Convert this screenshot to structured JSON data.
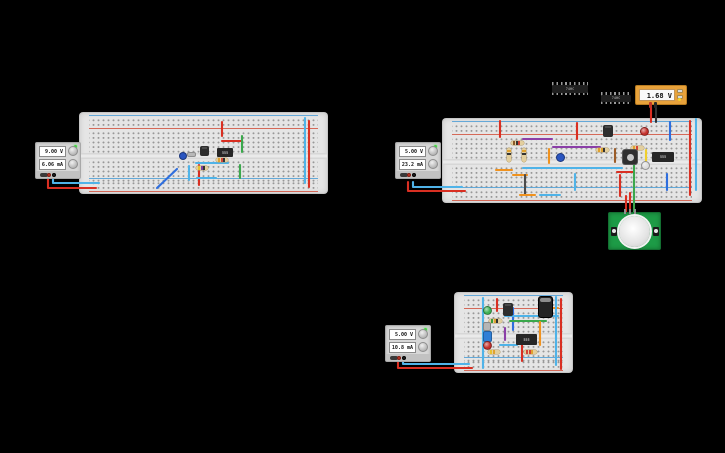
{
  "app": {
    "background": "#000000"
  },
  "supplies": [
    {
      "name": "power-supply-1",
      "voltage": "9.00 V",
      "current": "6.06 mA"
    },
    {
      "name": "power-supply-2",
      "voltage": "5.00 V",
      "current": "23.2 mA"
    },
    {
      "name": "power-supply-3",
      "voltage": "5.00 V",
      "current": "10.8 mA"
    }
  ],
  "multimeter": {
    "reading": "1.68 V",
    "accent": "#e8a23b"
  },
  "ics": [
    {
      "label": "74HC"
    },
    {
      "label": "74HC"
    }
  ],
  "colors": {
    "red": "#d92f22",
    "cyan": "#4fb3e8",
    "blue": "#2e6ede",
    "green": "#3aa84c",
    "orange": "#f0921e",
    "yellow": "#efcf2e",
    "purple": "#8b3fa8",
    "brown": "#9c5c28",
    "dark": "#4a4a4a",
    "black": "#333333",
    "board": "#e5e5e5",
    "led_red": "#c4302b",
    "led_green": "#3cb052",
    "led_white": "#dcdcdc"
  },
  "wires": [
    {
      "c": "red",
      "p": [
        [
          48,
          174
        ],
        [
          48,
          188
        ],
        [
          96,
          188
        ]
      ]
    },
    {
      "c": "cyan",
      "p": [
        [
          53,
          174
        ],
        [
          53,
          183
        ],
        [
          99,
          183
        ]
      ]
    },
    {
      "c": "red",
      "p": [
        [
          222,
          122
        ],
        [
          222,
          136
        ]
      ]
    },
    {
      "c": "red",
      "p": [
        [
          222,
          141
        ],
        [
          242,
          141
        ]
      ]
    },
    {
      "c": "green",
      "p": [
        [
          242,
          136
        ],
        [
          242,
          152
        ]
      ]
    },
    {
      "c": "green",
      "p": [
        [
          240,
          165
        ],
        [
          240,
          178
        ]
      ]
    },
    {
      "c": "cyan",
      "p": [
        [
          196,
          163
        ],
        [
          228,
          163
        ]
      ]
    },
    {
      "c": "red",
      "p": [
        [
          199,
          165
        ],
        [
          199,
          185
        ]
      ]
    },
    {
      "c": "cyan",
      "p": [
        [
          189,
          166
        ],
        [
          189,
          180
        ]
      ]
    },
    {
      "c": "blue",
      "p": [
        [
          157,
          188
        ],
        [
          177,
          169
        ]
      ]
    },
    {
      "c": "cyan",
      "p": [
        [
          197,
          178
        ],
        [
          216,
          178
        ]
      ]
    },
    {
      "c": "cyan",
      "p": [
        [
          305,
          118
        ],
        [
          305,
          183
        ]
      ]
    },
    {
      "c": "red",
      "p": [
        [
          309,
          121
        ],
        [
          309,
          187
        ]
      ]
    },
    {
      "c": "red",
      "p": [
        [
          408,
          182
        ],
        [
          408,
          191
        ],
        [
          465,
          191
        ]
      ]
    },
    {
      "c": "cyan",
      "p": [
        [
          413,
          182
        ],
        [
          413,
          187
        ],
        [
          462,
          187
        ]
      ]
    },
    {
      "c": "red",
      "p": [
        [
          500,
          121
        ],
        [
          500,
          137
        ]
      ]
    },
    {
      "c": "red",
      "p": [
        [
          577,
          123
        ],
        [
          577,
          139
        ]
      ]
    },
    {
      "c": "blue",
      "p": [
        [
          670,
          122
        ],
        [
          670,
          140
        ]
      ]
    },
    {
      "c": "purple",
      "p": [
        [
          523,
          139
        ],
        [
          552,
          139
        ]
      ]
    },
    {
      "c": "purple",
      "p": [
        [
          553,
          147
        ],
        [
          600,
          147
        ]
      ]
    },
    {
      "c": "orange",
      "p": [
        [
          549,
          149
        ],
        [
          549,
          163
        ]
      ]
    },
    {
      "c": "brown",
      "p": [
        [
          615,
          149
        ],
        [
          615,
          162
        ]
      ]
    },
    {
      "c": "yellow",
      "p": [
        [
          646,
          150
        ],
        [
          646,
          162
        ]
      ]
    },
    {
      "c": "cyan",
      "p": [
        [
          523,
          168
        ],
        [
          622,
          168
        ]
      ]
    },
    {
      "c": "orange",
      "p": [
        [
          496,
          170
        ],
        [
          512,
          170
        ]
      ]
    },
    {
      "c": "orange",
      "p": [
        [
          513,
          175
        ],
        [
          527,
          175
        ]
      ]
    },
    {
      "c": "red",
      "p": [
        [
          617,
          172
        ],
        [
          634,
          172
        ]
      ]
    },
    {
      "c": "dark",
      "p": [
        [
          525,
          175
        ],
        [
          525,
          194
        ]
      ]
    },
    {
      "c": "cyan",
      "p": [
        [
          575,
          174
        ],
        [
          575,
          190
        ]
      ]
    },
    {
      "c": "red",
      "p": [
        [
          620,
          175
        ],
        [
          620,
          196
        ]
      ]
    },
    {
      "c": "blue",
      "p": [
        [
          667,
          174
        ],
        [
          667,
          190
        ]
      ]
    },
    {
      "c": "green",
      "p": [
        [
          634,
          160
        ],
        [
          634,
          213
        ]
      ]
    },
    {
      "c": "red",
      "p": [
        [
          626,
          196
        ],
        [
          626,
          213
        ]
      ]
    },
    {
      "c": "red",
      "p": [
        [
          630,
          193
        ],
        [
          630,
          213
        ]
      ]
    },
    {
      "c": "red",
      "p": [
        [
          651,
          106
        ],
        [
          651,
          122
        ]
      ]
    },
    {
      "c": "black",
      "p": [
        [
          656,
          106
        ],
        [
          656,
          122
        ]
      ]
    },
    {
      "c": "red",
      "p": [
        [
          690,
          121
        ],
        [
          690,
          195
        ]
      ]
    },
    {
      "c": "cyan",
      "p": [
        [
          696,
          119
        ],
        [
          696,
          190
        ]
      ]
    },
    {
      "c": "orange",
      "p": [
        [
          520,
          195
        ],
        [
          535,
          195
        ]
      ]
    },
    {
      "c": "cyan",
      "p": [
        [
          540,
          195
        ],
        [
          560,
          195
        ]
      ]
    },
    {
      "c": "red",
      "p": [
        [
          398,
          362
        ],
        [
          398,
          368
        ],
        [
          472,
          368
        ]
      ]
    },
    {
      "c": "cyan",
      "p": [
        [
          403,
          362
        ],
        [
          403,
          364
        ],
        [
          469,
          364
        ]
      ]
    },
    {
      "c": "cyan",
      "p": [
        [
          483,
          298
        ],
        [
          483,
          368
        ]
      ]
    },
    {
      "c": "red",
      "p": [
        [
          497,
          299
        ],
        [
          497,
          311
        ]
      ]
    },
    {
      "c": "blue",
      "p": [
        [
          513,
          308
        ],
        [
          513,
          330
        ]
      ]
    },
    {
      "c": "cyan",
      "p": [
        [
          505,
          316
        ],
        [
          558,
          316
        ]
      ]
    },
    {
      "c": "orange",
      "p": [
        [
          545,
          308
        ],
        [
          558,
          308
        ]
      ]
    },
    {
      "c": "green",
      "p": [
        [
          510,
          321
        ],
        [
          546,
          321
        ]
      ]
    },
    {
      "c": "orange",
      "p": [
        [
          540,
          322
        ],
        [
          540,
          345
        ]
      ]
    },
    {
      "c": "purple",
      "p": [
        [
          505,
          328
        ],
        [
          505,
          340
        ]
      ]
    },
    {
      "c": "red",
      "p": [
        [
          522,
          345
        ],
        [
          522,
          361
        ]
      ]
    },
    {
      "c": "cyan",
      "p": [
        [
          500,
          345
        ],
        [
          517,
          345
        ]
      ]
    },
    {
      "c": "cyan",
      "p": [
        [
          556,
          297
        ],
        [
          556,
          365
        ]
      ]
    },
    {
      "c": "red",
      "p": [
        [
          561,
          299
        ],
        [
          561,
          369
        ]
      ]
    }
  ],
  "parts": [
    {
      "t": "disc",
      "name": "capacitor-disc",
      "x": 179,
      "y": 152,
      "w": 8,
      "h": 8,
      "c": "#2a55c0"
    },
    {
      "t": "crystal",
      "name": "crystal",
      "x": 187,
      "y": 152,
      "w": 9,
      "h": 5
    },
    {
      "t": "transistor",
      "name": "transistor",
      "x": 200,
      "y": 146,
      "w": 9,
      "h": 10
    },
    {
      "t": "chip",
      "name": "timer-ic",
      "x": 217,
      "y": 148,
      "w": 16,
      "h": 9,
      "label": "555"
    },
    {
      "t": "res_h",
      "name": "resistor",
      "x": 216,
      "y": 158,
      "w": 12,
      "h": 4,
      "bands": [
        "#e0a12f",
        "#d44436",
        "#333333"
      ]
    },
    {
      "t": "res_h",
      "name": "resistor",
      "x": 196,
      "y": 166,
      "w": 12,
      "h": 4,
      "bands": [
        "#e8c12f",
        "#7b3fa0",
        "#333333"
      ]
    },
    {
      "t": "res_h",
      "name": "resistor",
      "x": 511,
      "y": 141,
      "w": 13,
      "h": 4,
      "bands": [
        "#8a5a2a",
        "#333333",
        "#d44436"
      ]
    },
    {
      "t": "res_v",
      "name": "resistor",
      "x": 507,
      "y": 148,
      "w": 4,
      "h": 14,
      "bands": [
        "#e0a12f",
        "#333333"
      ]
    },
    {
      "t": "res_v",
      "name": "resistor",
      "x": 522,
      "y": 148,
      "w": 4,
      "h": 14,
      "bands": [
        "#e0a12f",
        "#333333"
      ]
    },
    {
      "t": "disc",
      "name": "capacitor-disc",
      "x": 556,
      "y": 153,
      "w": 9,
      "h": 9,
      "c": "#2a55c0"
    },
    {
      "t": "transistor",
      "name": "transistor",
      "x": 603,
      "y": 125,
      "w": 10,
      "h": 12
    },
    {
      "t": "led",
      "name": "led-red",
      "x": 640,
      "y": 127,
      "w": 9,
      "h": 9,
      "c": "#c4302b"
    },
    {
      "t": "res_h",
      "name": "resistor",
      "x": 596,
      "y": 148,
      "w": 13,
      "h": 4,
      "bands": [
        "#e0a12f",
        "#e0a12f",
        "#333333"
      ]
    },
    {
      "t": "res_h",
      "name": "resistor",
      "x": 631,
      "y": 146,
      "w": 13,
      "h": 4,
      "bands": [
        "#e0a12f",
        "#d44436"
      ]
    },
    {
      "t": "pushbutton",
      "name": "pushbutton",
      "x": 623,
      "y": 150,
      "w": 14,
      "h": 14
    },
    {
      "t": "chip",
      "name": "timer-ic",
      "x": 652,
      "y": 152,
      "w": 22,
      "h": 10,
      "label": "555"
    },
    {
      "t": "led",
      "name": "led-white",
      "x": 641,
      "y": 161,
      "w": 9,
      "h": 9,
      "c": "#dcdcdc"
    },
    {
      "t": "led",
      "name": "led-green",
      "x": 483,
      "y": 306,
      "w": 9,
      "h": 9,
      "c": "#3cb052"
    },
    {
      "t": "transistor",
      "name": "transistor",
      "x": 503,
      "y": 303,
      "w": 10,
      "h": 13
    },
    {
      "t": "ecap",
      "name": "capacitor-electrolytic",
      "x": 538,
      "y": 296,
      "w": 15,
      "h": 22
    },
    {
      "t": "res_h",
      "name": "resistor",
      "x": 489,
      "y": 319,
      "w": 13,
      "h": 4,
      "bands": [
        "#3a9c3a",
        "#e0a12f",
        "#333333"
      ]
    },
    {
      "t": "caprect",
      "name": "capacitor",
      "x": 483,
      "y": 322,
      "w": 8,
      "h": 9,
      "c": "#b5b5b5"
    },
    {
      "t": "caprect",
      "name": "capacitor",
      "x": 483,
      "y": 331,
      "w": 9,
      "h": 11,
      "c": "#2f7fd6"
    },
    {
      "t": "chip",
      "name": "timer-ic",
      "x": 516,
      "y": 334,
      "w": 21,
      "h": 11,
      "label": "555"
    },
    {
      "t": "led",
      "name": "led-red",
      "x": 483,
      "y": 341,
      "w": 9,
      "h": 9,
      "c": "#c4302b"
    },
    {
      "t": "res_h",
      "name": "resistor",
      "x": 488,
      "y": 350,
      "w": 12,
      "h": 4,
      "bands": [
        "#e8c12f",
        "#e0a12f"
      ]
    },
    {
      "t": "res_h",
      "name": "resistor",
      "x": 524,
      "y": 350,
      "w": 13,
      "h": 4,
      "bands": [
        "#d44436",
        "#d44436",
        "#e0a12f"
      ]
    }
  ]
}
